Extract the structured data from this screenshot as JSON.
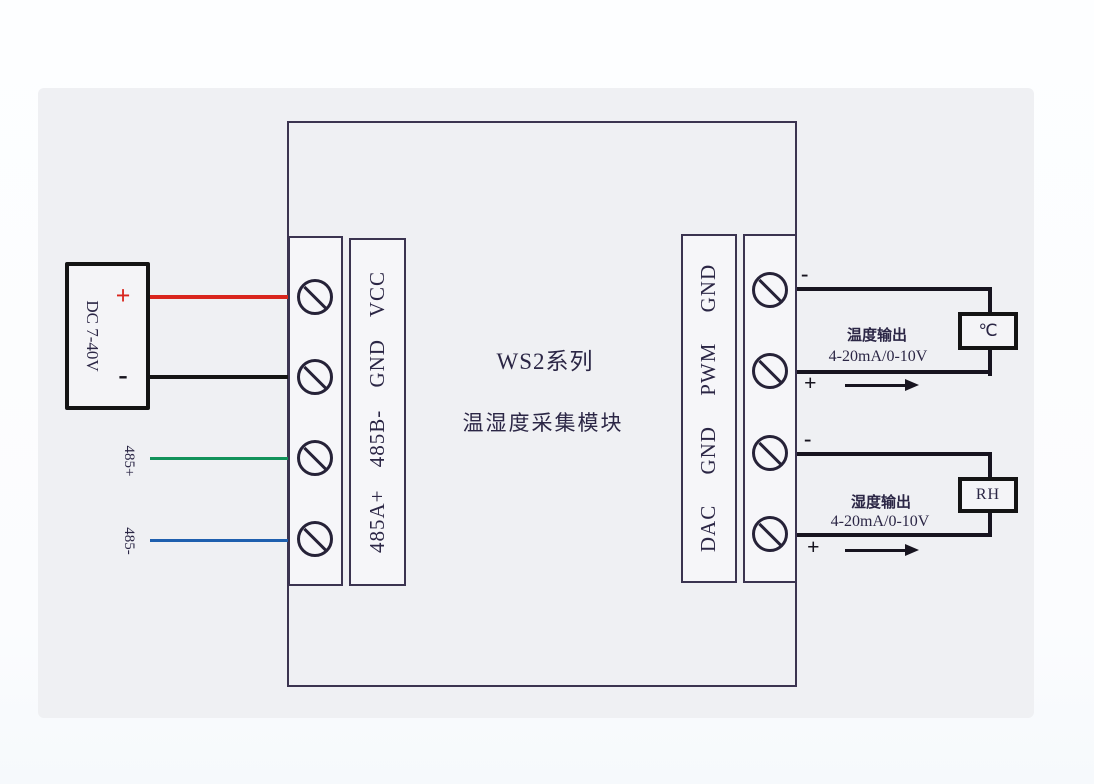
{
  "module": {
    "title_line1": "WS2系列",
    "title_line2": "温湿度采集模块"
  },
  "power_supply": {
    "label": "DC 7-40V",
    "plus": "+",
    "minus": "-"
  },
  "rs485": {
    "plus_label": "485+",
    "minus_label": "485-"
  },
  "left_terminal": {
    "labels_rotated": "485A+ 485B- GND VCC"
  },
  "right_terminal": {
    "labels_rotated": "DAC GND PWM GND"
  },
  "temperature_output": {
    "minus": "-",
    "plus": "+",
    "name": "温度输出",
    "range": "4-20mA/0-10V",
    "sensor_label": "℃"
  },
  "humidity_output": {
    "minus": "-",
    "plus": "+",
    "name": "湿度输出",
    "range": "4-20mA/0-10V",
    "sensor_label": "RH"
  },
  "colors": {
    "vcc_wire": "#d9251d",
    "gnd_wire": "#141414",
    "wire_485_plus": "#12925a",
    "wire_485_minus": "#1e5fae",
    "diagram_line": "#3b3450",
    "text": "#2b2645"
  }
}
